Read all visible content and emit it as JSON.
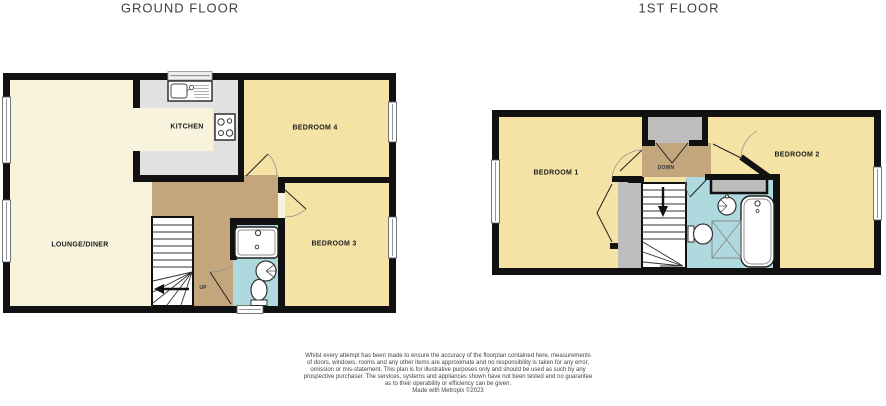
{
  "titles": {
    "ground": "GROUND FLOOR",
    "first": "1ST FLOOR"
  },
  "ground_floor": {
    "label_lounge": "LOUNGE/DINER",
    "label_kitchen": "KITCHEN",
    "label_bedroom4": "BEDROOM 4",
    "label_bedroom3": "BEDROOM 3",
    "stairs_direction": "UP"
  },
  "first_floor": {
    "label_bedroom1": "BEDROOM 1",
    "label_bedroom2": "BEDROOM 2",
    "stairs_direction": "DOWN"
  },
  "fixture_icons": [
    "kitchen-sink-icon",
    "hob-icon",
    "bath-icon",
    "basin-icon",
    "toilet-icon",
    "shower-icon",
    "stairs-icon",
    "window-icon",
    "door-icon",
    "wardrobe-icon",
    "cupboard-icon"
  ],
  "disclaimer": {
    "lines": [
      "Whilst every attempt has been made to ensure the accuracy of the floorplan contained here, measurements",
      "of doors, windows, rooms and any other items are approximate and no responsibility is taken for any error,",
      "omission or mis-statement. This plan is for illustrative purposes only and should be used as such by any",
      "prospective purchaser. The services, systems and appliances shown have not been tested and no guarantee",
      "as to their operability or efficiency can be given."
    ],
    "credit": "Made with Metropix ©2023"
  },
  "colors": {
    "wall": "#111111",
    "lounge_cream": "#F8F3DC",
    "bedroom_yellow": "#F5E3A6",
    "kitchen_gray": "#E2E2E2",
    "hall_brown": "#C3A67C",
    "bath_blue": "#AED9DE",
    "closet_gray": "#BDBDBD"
  }
}
